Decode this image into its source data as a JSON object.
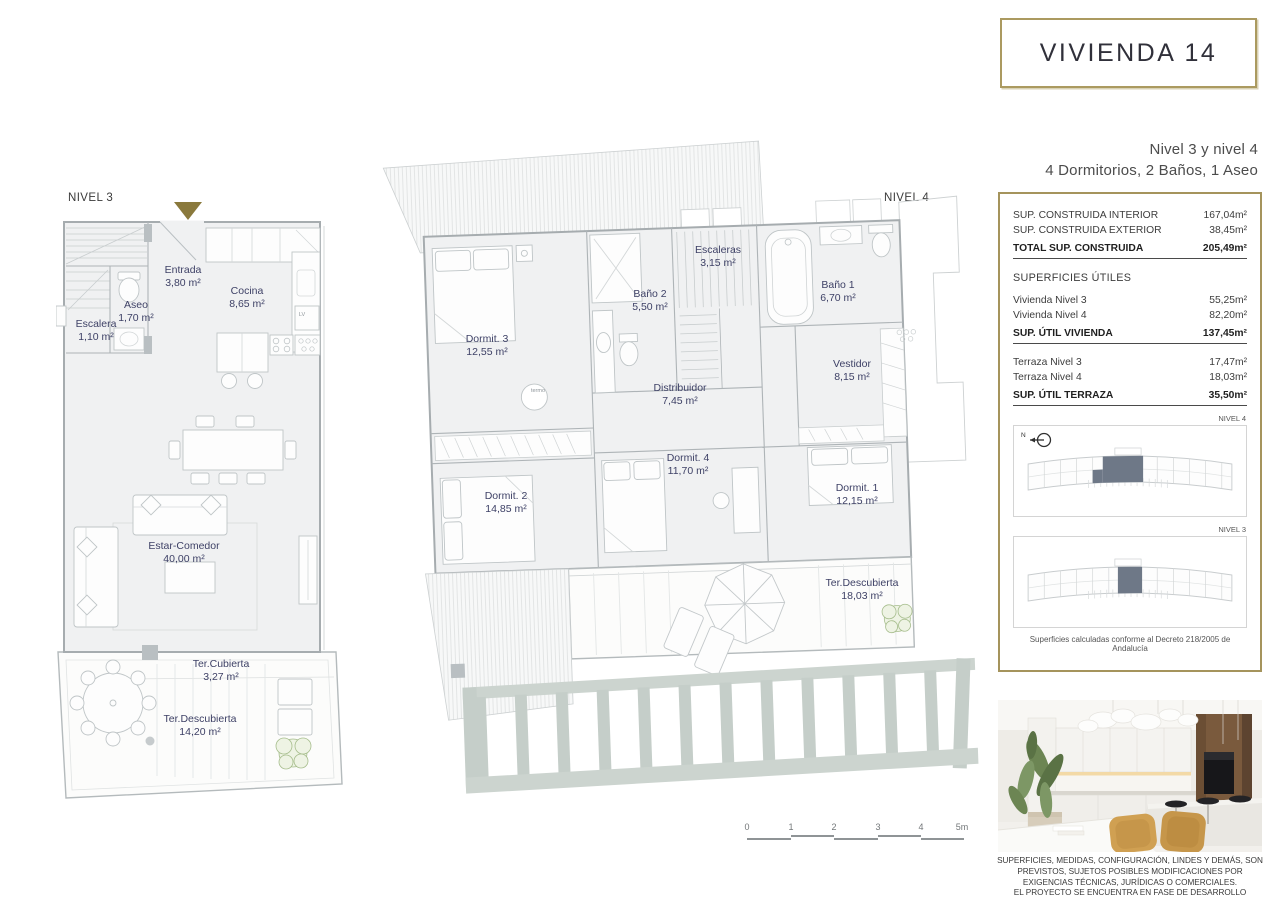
{
  "header": {
    "title": "VIVIENDA 14",
    "level_line": "Nivel 3 y nivel 4",
    "rooms_line": "4 Dormitorios, 2 Baños, 1 Aseo"
  },
  "areas": {
    "rows_built": [
      {
        "label": "SUP. CONSTRUIDA INTERIOR",
        "value": "167,04m²"
      },
      {
        "label": "SUP. CONSTRUIDA EXTERIOR",
        "value": "38,45m²"
      },
      {
        "label": "TOTAL SUP. CONSTRUIDA",
        "value": "205,49m²"
      }
    ],
    "useful_title": "SUPERFICIES ÚTILES",
    "rows_useful": [
      {
        "label": "Vivienda Nivel 3",
        "value": "55,25m²"
      },
      {
        "label": "Vivienda Nivel 4",
        "value": "82,20m²"
      },
      {
        "label": "SUP. ÚTIL VIVIENDA",
        "value": "137,45m²"
      }
    ],
    "rows_terrace": [
      {
        "label": "Terraza Nivel 3",
        "value": "17,47m²"
      },
      {
        "label": "Terraza Nivel 4",
        "value": "18,03m²"
      },
      {
        "label": "SUP. ÚTIL TERRAZA",
        "value": "35,50m²"
      }
    ],
    "footnote": "Superficies calculadas conforme al Decreto 218/2005 de Andalucía"
  },
  "keyplans": {
    "top_label": "NIVEL 4",
    "bottom_label": "NIVEL 3",
    "north": "N"
  },
  "plan3": {
    "name": "NIVEL 3",
    "kitchen_lv": "LV",
    "rooms": {
      "escalera": {
        "name": "Escalera",
        "area": "1,10 m²"
      },
      "aseo": {
        "name": "Aseo",
        "area": "1,70 m²"
      },
      "entrada": {
        "name": "Entrada",
        "area": "3,80 m²"
      },
      "cocina": {
        "name": "Cocina",
        "area": "8,65 m²"
      },
      "estar": {
        "name": "Estar-Comedor",
        "area": "40,00 m²"
      },
      "tercubierta": {
        "name": "Ter.Cubierta",
        "area": "3,27 m²"
      },
      "terdescubierta": {
        "name": "Ter.Descubierta",
        "area": "14,20 m²"
      }
    }
  },
  "plan4": {
    "name": "NIVEL 4",
    "termo": "termo",
    "rooms": {
      "dormit3": {
        "name": "Dormit. 3",
        "area": "12,55 m²"
      },
      "bano2": {
        "name": "Baño 2",
        "area": "5,50 m²"
      },
      "escaleras": {
        "name": "Escaleras",
        "area": "3,15 m²"
      },
      "bano1": {
        "name": "Baño 1",
        "area": "6,70 m²"
      },
      "vestidor": {
        "name": "Vestidor",
        "area": "8,15 m²"
      },
      "distribuidor": {
        "name": "Distribuidor",
        "area": "7,45 m²"
      },
      "dormit4": {
        "name": "Dormit. 4",
        "area": "11,70 m²"
      },
      "dormit2": {
        "name": "Dormit. 2",
        "area": "14,85 m²"
      },
      "dormit1": {
        "name": "Dormit. 1",
        "area": "12,15 m²"
      },
      "terdescubierta": {
        "name": "Ter.Descubierta",
        "area": "18,03 m²"
      }
    }
  },
  "scalebar": {
    "ticks": [
      "0",
      "1",
      "2",
      "3",
      "4",
      "5m"
    ]
  },
  "disclaimer": {
    "line1": "SUPERFICIES, MEDIDAS, CONFIGURACIÓN, LINDES Y DEMÁS, SON",
    "line2": "PREVISTOS, SUJETOS POSIBLES MODIFICACIONES POR",
    "line3": "EXIGENCIAS TÉCNICAS, JURÍDICAS O COMERCIALES.",
    "line4": "EL PROYECTO SE ENCUENTRA EN FASE DE DESARROLLO"
  },
  "colors": {
    "gold_border": "#ab9a60",
    "entrance_triangle": "#8a793c",
    "room_label": "#3e4166",
    "plan_line": "#a6acaf",
    "keyplan_highlight": "#6e7887",
    "pergola": "#c5cec9"
  }
}
